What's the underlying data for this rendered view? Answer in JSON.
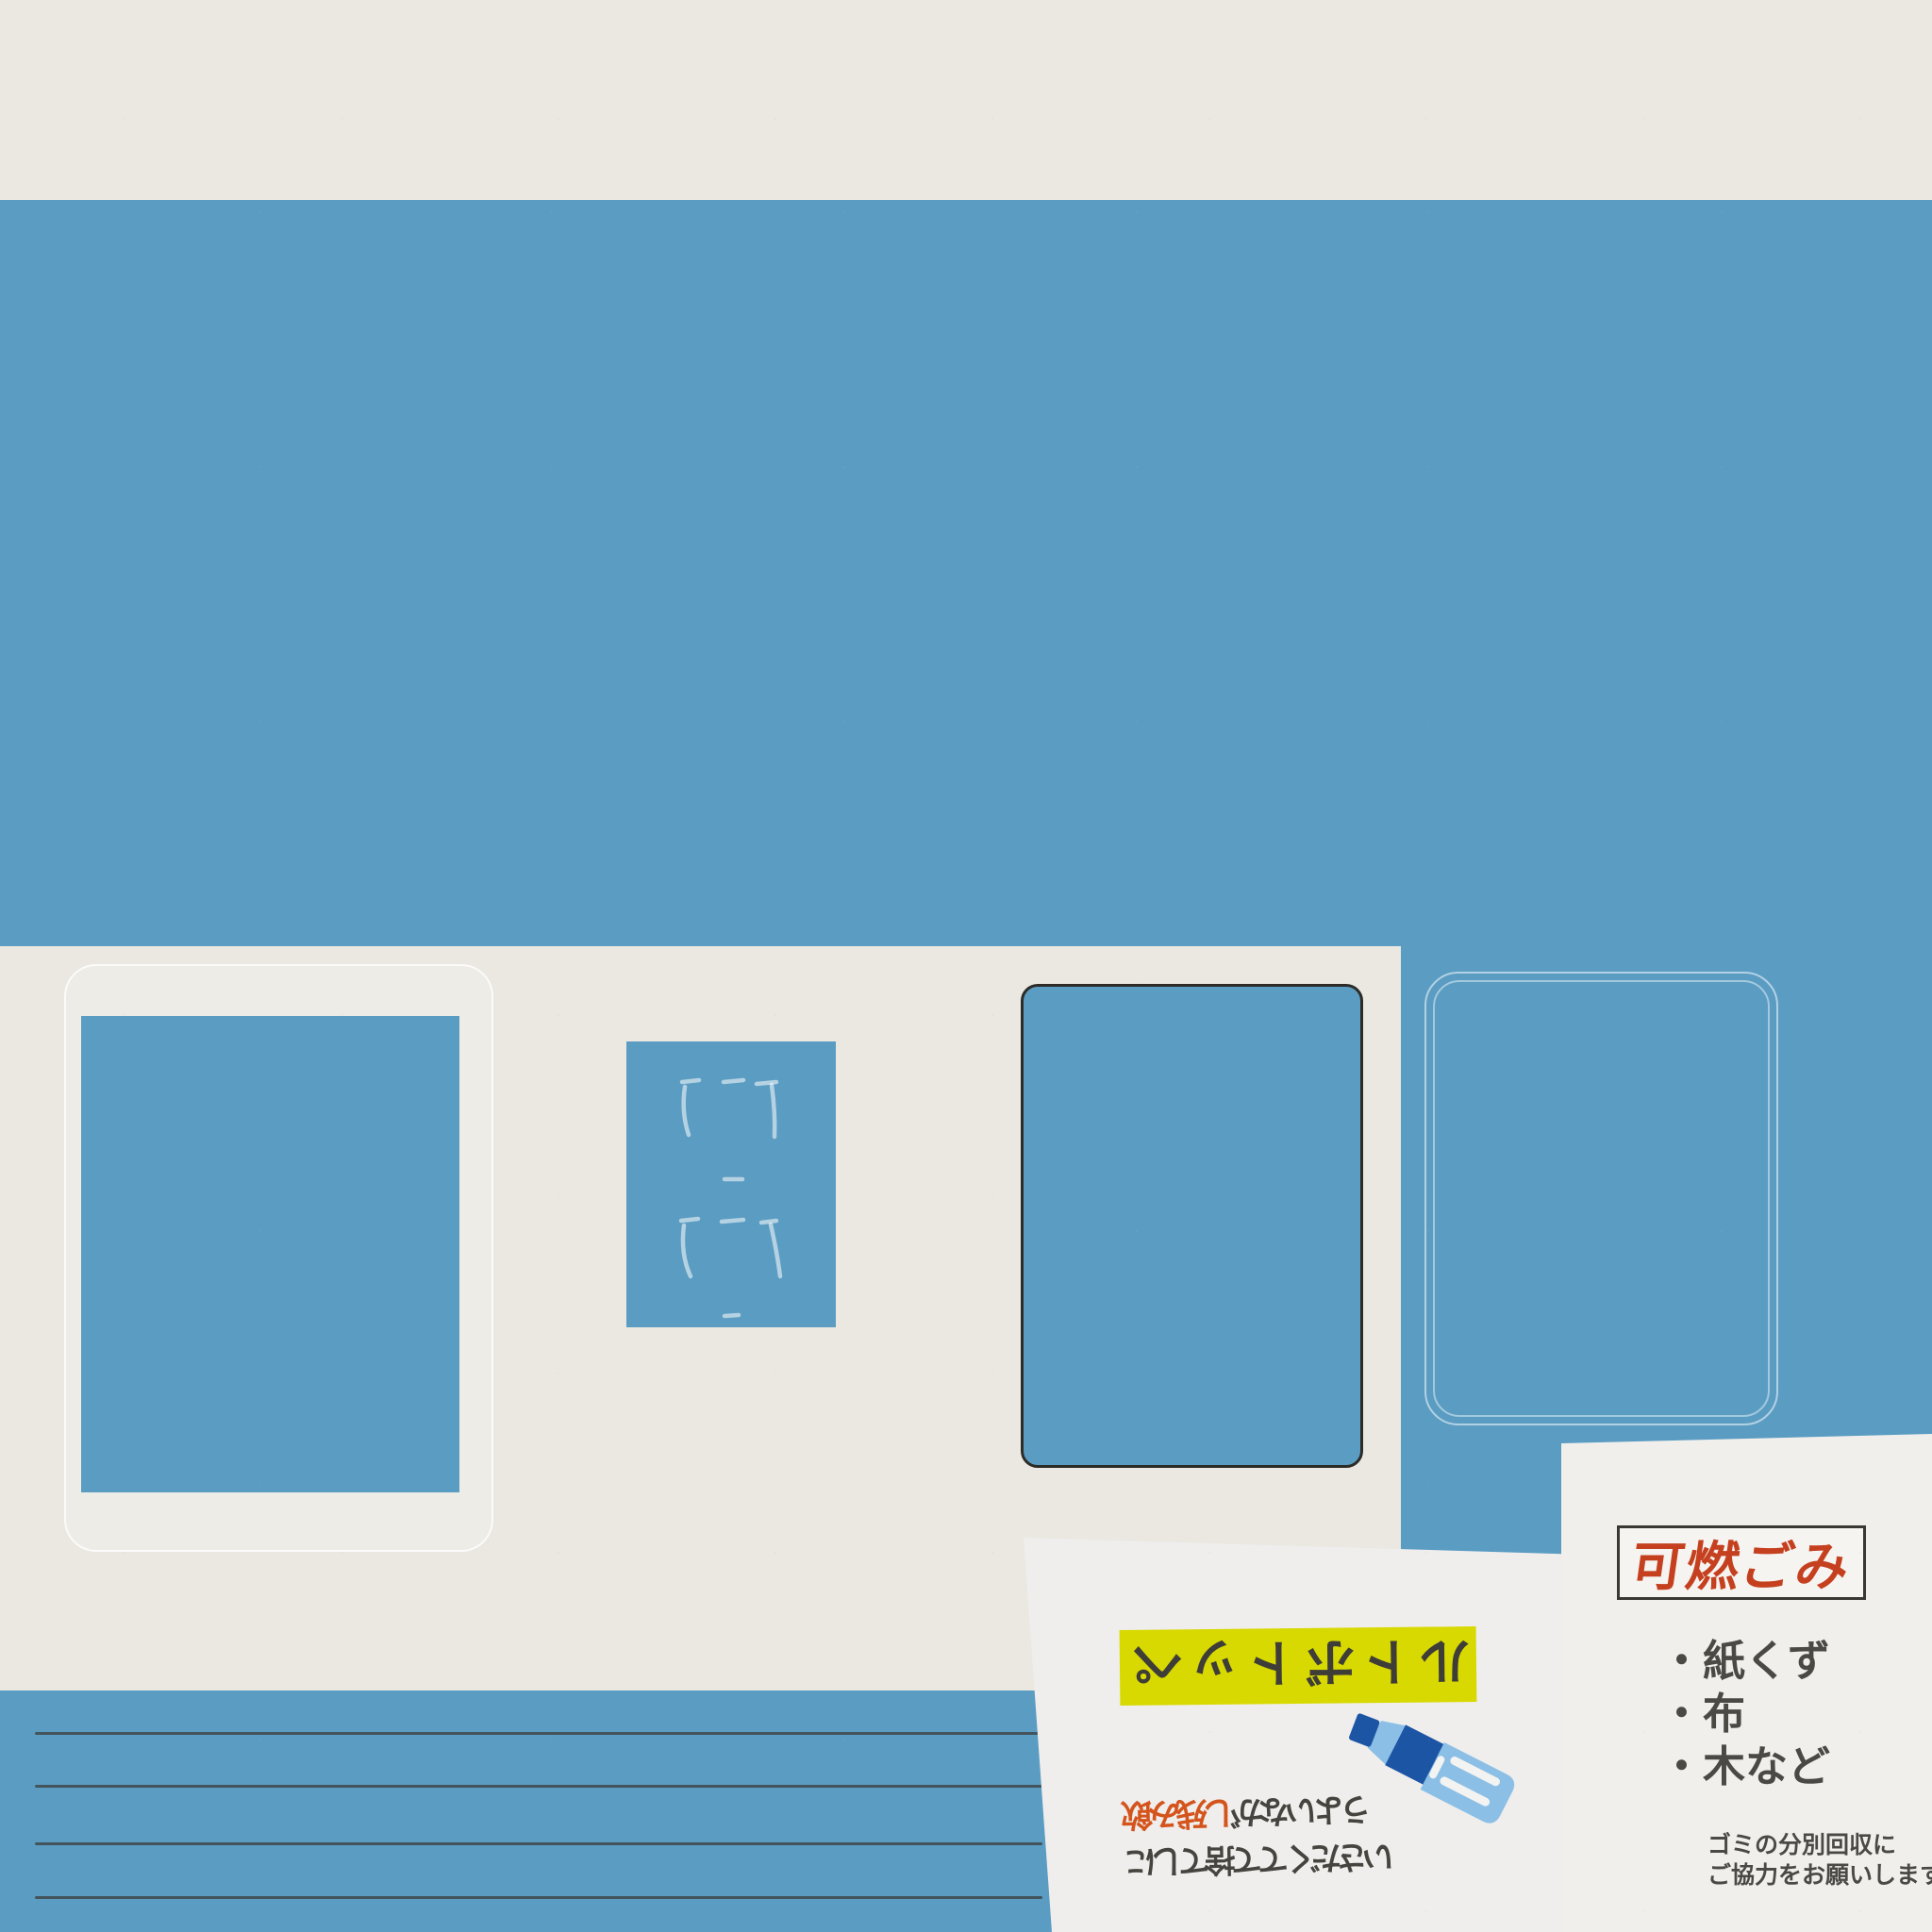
{
  "colors": {
    "wall_blue": "#5b9cc2",
    "wall_cream": "#eae8e1",
    "sign_white": "#efeeed",
    "banner_yellow": "#d8d900",
    "title_red": "#c5401f",
    "highlight_orange": "#d4541c",
    "text_dark_gray": "#46443f",
    "pencil_gray": "#3a3934",
    "poster_frame_dark": "#2d2b27",
    "chalk_white": "#ffffff",
    "bottle_dark_blue": "#1d55a5",
    "bottle_light_blue": "#8cbfe6"
  },
  "pet_bottle_sign": {
    "banner_label": "ペットボトル",
    "note_line1_highlight": "飲み残し",
    "note_line1_rest": "がないよう",
    "note_line2": "にして捨ててください",
    "icon": "pet-bottle-icon",
    "text_orientation": "characters rotated 180 degrees"
  },
  "burnable_waste_sign": {
    "title": "可燃ごみ",
    "bullet": "・",
    "items": [
      "紙くず",
      "布",
      "木など"
    ],
    "footer_line1": "ゴミの分別回収に",
    "footer_line2": "ご協力をお願いします"
  }
}
